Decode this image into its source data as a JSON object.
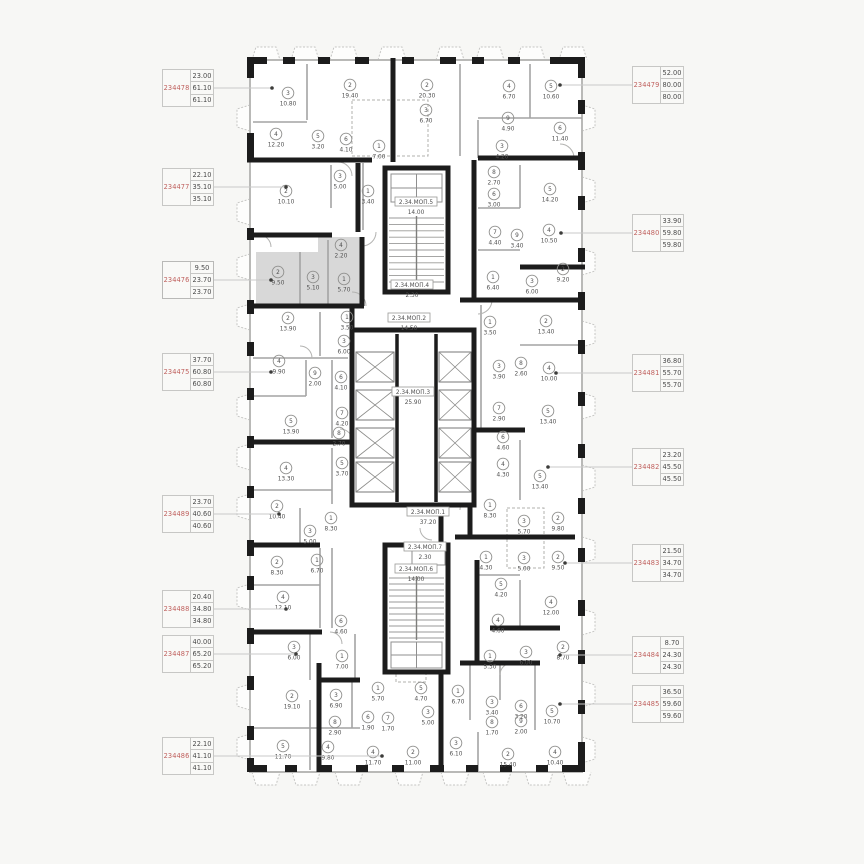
{
  "plan": {
    "selected_unit": "234476",
    "colors": {
      "unit_id_text": "#bf5f5c",
      "value_text": "#4a4a4a",
      "wall": "#1c1c1c",
      "partition": "#a3a3a3",
      "highlight_fill": "#d8d8d8",
      "connector": "#c9c9c9"
    },
    "mop_labels": [
      {
        "name": "2.34.МОП.5",
        "area": "14.00",
        "x": 416,
        "y": 203
      },
      {
        "name": "2.34.МОП.4",
        "area": "2.30",
        "x": 412,
        "y": 286
      },
      {
        "name": "2.34.МОП.2",
        "area": "14.50",
        "x": 409,
        "y": 319
      },
      {
        "name": "2.34.МОП.3",
        "area": "25.90",
        "x": 413,
        "y": 393
      },
      {
        "name": "2.34.МОП.1",
        "area": "37.20",
        "x": 428,
        "y": 513
      },
      {
        "name": "2.34.МОП.7",
        "area": "2.30",
        "x": 425,
        "y": 548
      },
      {
        "name": "2.34.МОП.6",
        "area": "14.00",
        "x": 416,
        "y": 570
      }
    ],
    "rooms": [
      {
        "n": "3",
        "a": "10.80",
        "x": 288,
        "y": 93
      },
      {
        "n": "2",
        "a": "19.40",
        "x": 350,
        "y": 85
      },
      {
        "n": "2",
        "a": "20.30",
        "x": 427,
        "y": 85
      },
      {
        "n": "4",
        "a": "6.70",
        "x": 509,
        "y": 86
      },
      {
        "n": "5",
        "a": "10.60",
        "x": 551,
        "y": 86
      },
      {
        "n": "4",
        "a": "12.20",
        "x": 276,
        "y": 134
      },
      {
        "n": "5",
        "a": "3.20",
        "x": 318,
        "y": 136
      },
      {
        "n": "6",
        "a": "4.10",
        "x": 346,
        "y": 139
      },
      {
        "n": "1",
        "a": "7.00",
        "x": 379,
        "y": 146
      },
      {
        "n": "3",
        "a": "6.70",
        "x": 426,
        "y": 110
      },
      {
        "n": "9",
        "a": "4.90",
        "x": 508,
        "y": 118
      },
      {
        "n": "6",
        "a": "11.40",
        "x": 560,
        "y": 128
      },
      {
        "n": "3",
        "a": "4.20",
        "x": 502,
        "y": 146
      },
      {
        "n": "2",
        "a": "10.10",
        "x": 286,
        "y": 191
      },
      {
        "n": "3",
        "a": "5.00",
        "x": 340,
        "y": 176
      },
      {
        "n": "1",
        "a": "3.40",
        "x": 368,
        "y": 191
      },
      {
        "n": "8",
        "a": "2.70",
        "x": 494,
        "y": 172
      },
      {
        "n": "6",
        "a": "3.00",
        "x": 494,
        "y": 194
      },
      {
        "n": "5",
        "a": "14.20",
        "x": 550,
        "y": 189
      },
      {
        "n": "7",
        "a": "4.40",
        "x": 495,
        "y": 232
      },
      {
        "n": "9",
        "a": "3.40",
        "x": 517,
        "y": 235
      },
      {
        "n": "4",
        "a": "10.50",
        "x": 549,
        "y": 230
      },
      {
        "n": "1",
        "a": "6.40",
        "x": 493,
        "y": 277
      },
      {
        "n": "3",
        "a": "6.00",
        "x": 532,
        "y": 281
      },
      {
        "n": "2",
        "a": "9.20",
        "x": 563,
        "y": 269
      },
      {
        "n": "4",
        "a": "2.20",
        "x": 341,
        "y": 245
      },
      {
        "n": "2",
        "a": "9.50",
        "x": 278,
        "y": 272
      },
      {
        "n": "3",
        "a": "5.10",
        "x": 313,
        "y": 277
      },
      {
        "n": "1",
        "a": "5.70",
        "x": 344,
        "y": 279
      },
      {
        "n": "2",
        "a": "13.90",
        "x": 288,
        "y": 318
      },
      {
        "n": "1",
        "a": "3.50",
        "x": 347,
        "y": 317
      },
      {
        "n": "3",
        "a": "6.00",
        "x": 344,
        "y": 341
      },
      {
        "n": "4",
        "a": "9.90",
        "x": 279,
        "y": 361
      },
      {
        "n": "9",
        "a": "2.00",
        "x": 315,
        "y": 373
      },
      {
        "n": "6",
        "a": "4.10",
        "x": 341,
        "y": 377
      },
      {
        "n": "7",
        "a": "4.20",
        "x": 342,
        "y": 413
      },
      {
        "n": "5",
        "a": "13.90",
        "x": 291,
        "y": 421
      },
      {
        "n": "8",
        "a": "2.70",
        "x": 339,
        "y": 433
      },
      {
        "n": "1",
        "a": "3.50",
        "x": 490,
        "y": 322
      },
      {
        "n": "2",
        "a": "13.40",
        "x": 546,
        "y": 321
      },
      {
        "n": "3",
        "a": "3.90",
        "x": 499,
        "y": 366
      },
      {
        "n": "8",
        "a": "2.60",
        "x": 521,
        "y": 363
      },
      {
        "n": "4",
        "a": "10.00",
        "x": 549,
        "y": 368
      },
      {
        "n": "7",
        "a": "2.90",
        "x": 499,
        "y": 408
      },
      {
        "n": "5",
        "a": "13.40",
        "x": 548,
        "y": 411
      },
      {
        "n": "6",
        "a": "4.60",
        "x": 503,
        "y": 437
      },
      {
        "n": "4",
        "a": "4.30",
        "x": 503,
        "y": 464
      },
      {
        "n": "5",
        "a": "13.40",
        "x": 540,
        "y": 476
      },
      {
        "n": "5",
        "a": "3.70",
        "x": 342,
        "y": 463
      },
      {
        "n": "4",
        "a": "13.30",
        "x": 286,
        "y": 468
      },
      {
        "n": "2",
        "a": "10.40",
        "x": 277,
        "y": 506
      },
      {
        "n": "1",
        "a": "8.30",
        "x": 331,
        "y": 518
      },
      {
        "n": "3",
        "a": "5.00",
        "x": 310,
        "y": 531
      },
      {
        "n": "1",
        "a": "8.30",
        "x": 490,
        "y": 505
      },
      {
        "n": "3",
        "a": "5.70",
        "x": 524,
        "y": 521
      },
      {
        "n": "2",
        "a": "9.80",
        "x": 558,
        "y": 518
      },
      {
        "n": "1",
        "a": "4.30",
        "x": 486,
        "y": 557
      },
      {
        "n": "3",
        "a": "5.00",
        "x": 524,
        "y": 558
      },
      {
        "n": "2",
        "a": "9.50",
        "x": 558,
        "y": 557
      },
      {
        "n": "5",
        "a": "4.20",
        "x": 501,
        "y": 584
      },
      {
        "n": "4",
        "a": "12.00",
        "x": 551,
        "y": 602
      },
      {
        "n": "4",
        "a": "4.60",
        "x": 498,
        "y": 620
      },
      {
        "n": "2",
        "a": "8.30",
        "x": 277,
        "y": 562
      },
      {
        "n": "1",
        "a": "6.70",
        "x": 317,
        "y": 560
      },
      {
        "n": "4",
        "a": "12.10",
        "x": 283,
        "y": 597
      },
      {
        "n": "6",
        "a": "4.60",
        "x": 341,
        "y": 621
      },
      {
        "n": "3",
        "a": "6.00",
        "x": 294,
        "y": 647
      },
      {
        "n": "1",
        "a": "7.00",
        "x": 342,
        "y": 656
      },
      {
        "n": "2",
        "a": "19.10",
        "x": 292,
        "y": 696
      },
      {
        "n": "3",
        "a": "6.90",
        "x": 336,
        "y": 695
      },
      {
        "n": "8",
        "a": "2.90",
        "x": 335,
        "y": 722
      },
      {
        "n": "5",
        "a": "11.70",
        "x": 283,
        "y": 746
      },
      {
        "n": "4",
        "a": "9.80",
        "x": 328,
        "y": 747
      },
      {
        "n": "1",
        "a": "5.70",
        "x": 378,
        "y": 688
      },
      {
        "n": "5",
        "a": "4.70",
        "x": 421,
        "y": 688
      },
      {
        "n": "6",
        "a": "1.90",
        "x": 368,
        "y": 717
      },
      {
        "n": "7",
        "a": "1.70",
        "x": 388,
        "y": 718
      },
      {
        "n": "3",
        "a": "5.00",
        "x": 428,
        "y": 712
      },
      {
        "n": "4",
        "a": "11.70",
        "x": 373,
        "y": 752
      },
      {
        "n": "2",
        "a": "11.00",
        "x": 413,
        "y": 752
      },
      {
        "n": "3",
        "a": "6.10",
        "x": 456,
        "y": 743
      },
      {
        "n": "1",
        "a": "5.30",
        "x": 490,
        "y": 656
      },
      {
        "n": "3",
        "a": "6.00",
        "x": 526,
        "y": 652
      },
      {
        "n": "2",
        "a": "8.70",
        "x": 563,
        "y": 647
      },
      {
        "n": "1",
        "a": "6.70",
        "x": 458,
        "y": 691
      },
      {
        "n": "3",
        "a": "3.40",
        "x": 492,
        "y": 702
      },
      {
        "n": "6",
        "a": "3.20",
        "x": 521,
        "y": 706
      },
      {
        "n": "8",
        "a": "1.70",
        "x": 492,
        "y": 722
      },
      {
        "n": "9",
        "a": "2.00",
        "x": 521,
        "y": 721
      },
      {
        "n": "5",
        "a": "10.70",
        "x": 552,
        "y": 711
      },
      {
        "n": "2",
        "a": "15.40",
        "x": 508,
        "y": 754
      },
      {
        "n": "4",
        "a": "10.40",
        "x": 555,
        "y": 752
      }
    ]
  },
  "left_units": [
    {
      "id": "234478",
      "values": [
        "23.00",
        "61.10",
        "61.10"
      ]
    },
    {
      "id": "234477",
      "values": [
        "22.10",
        "35.10",
        "35.10"
      ]
    },
    {
      "id": "234476",
      "values": [
        "9.50",
        "23.70",
        "23.70"
      ]
    },
    {
      "id": "234475",
      "values": [
        "37.70",
        "60.80",
        "60.80"
      ]
    },
    {
      "id": "234489",
      "values": [
        "23.70",
        "40.60",
        "40.60"
      ]
    },
    {
      "id": "234488",
      "values": [
        "20.40",
        "34.80",
        "34.80"
      ]
    },
    {
      "id": "234487",
      "values": [
        "40.00",
        "65.20",
        "65.20"
      ]
    },
    {
      "id": "234486",
      "values": [
        "22.10",
        "41.10",
        "41.10"
      ]
    }
  ],
  "right_units": [
    {
      "id": "234479",
      "values": [
        "52.00",
        "80.00",
        "80.00"
      ]
    },
    {
      "id": "234480",
      "values": [
        "33.90",
        "59.80",
        "59.80"
      ]
    },
    {
      "id": "234481",
      "values": [
        "36.80",
        "55.70",
        "55.70"
      ]
    },
    {
      "id": "234482",
      "values": [
        "23.20",
        "45.50",
        "45.50"
      ]
    },
    {
      "id": "234483",
      "values": [
        "21.50",
        "34.70",
        "34.70"
      ]
    },
    {
      "id": "234484",
      "values": [
        "8.70",
        "24.30",
        "24.30"
      ]
    },
    {
      "id": "234485",
      "values": [
        "36.50",
        "59.60",
        "59.60"
      ]
    }
  ]
}
